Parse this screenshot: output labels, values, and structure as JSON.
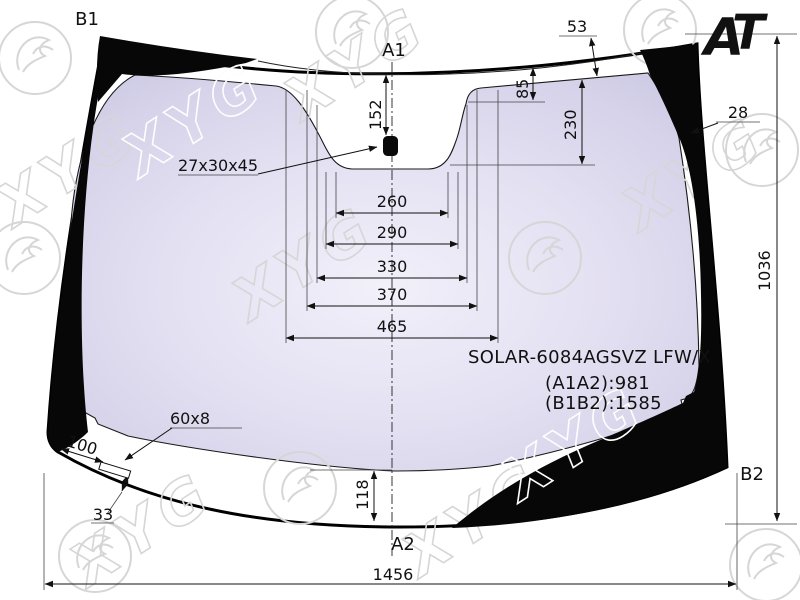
{
  "part": {
    "code": "SOLAR-6084AGSVZ LFW/X",
    "a1a2": "(A1A2):981",
    "b1b2": "(B1B2):1585"
  },
  "corner_labels": {
    "b1": "B1",
    "a1": "A1",
    "a2": "A2",
    "b2": "B2"
  },
  "dimensions": {
    "top_edge_offset": "53",
    "frit_top_drop": "85",
    "sensor_depth": "230",
    "side_band_width": "28",
    "mount_drop": "152",
    "mount_size": "27x30x45",
    "cutout_w1": "260",
    "cutout_w2": "290",
    "cutout_w3": "330",
    "cutout_w4": "370",
    "cutout_w5": "465",
    "glass_height": "1036",
    "glass_width": "1456",
    "bottom_band_height": "118",
    "edge_feature_offset": "100",
    "heater_size": "60x8",
    "edge_feature_depth": "33"
  },
  "logo": {
    "a": "A",
    "t": "T"
  },
  "watermark": {
    "text": "XYG"
  },
  "colors": {
    "glass_tint": "#d9d6ec",
    "band": "#070707",
    "logo_a": "#e87722",
    "logo_t": "#1c1cae",
    "watermark_gray": "#d6d6d6"
  }
}
